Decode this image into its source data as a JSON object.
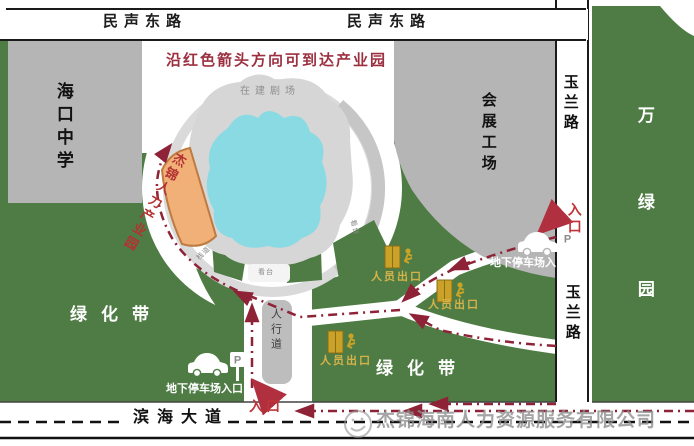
{
  "map": {
    "notice": "沿红色箭头方向可到达产业园",
    "roads": {
      "minsheng_east": "民声东路",
      "yulan": "玉兰路",
      "binhai_avenue": "滨海大道",
      "sidewalk": "人行道"
    },
    "places": {
      "haikou_school": "海口中学",
      "exhibition_workshop": "会展工场",
      "wanlv_garden": "万绿园",
      "green_belt": "绿化带",
      "theater_under_construction": "在建剧场",
      "industrial_park_building": "杰锦人力产业园"
    },
    "markers": {
      "entrance": "入口",
      "staff_exit": "人员出口",
      "underground_parking_entrance": "地下停车场入口",
      "parking_sign": "P"
    },
    "small_labels": {
      "walkway": "栈道",
      "stand": "看台"
    },
    "watermark": "杰锦海南人力资源服务有限公司",
    "colors": {
      "green_area": "#4e7c44",
      "gray_block": "#b5b5b5",
      "pond_cyan": "#89dae3",
      "building_orange": "#f0b078",
      "route_red": "#8e2236",
      "accent_red": "#c03438",
      "exit_gold": "#d0ab3c"
    }
  }
}
